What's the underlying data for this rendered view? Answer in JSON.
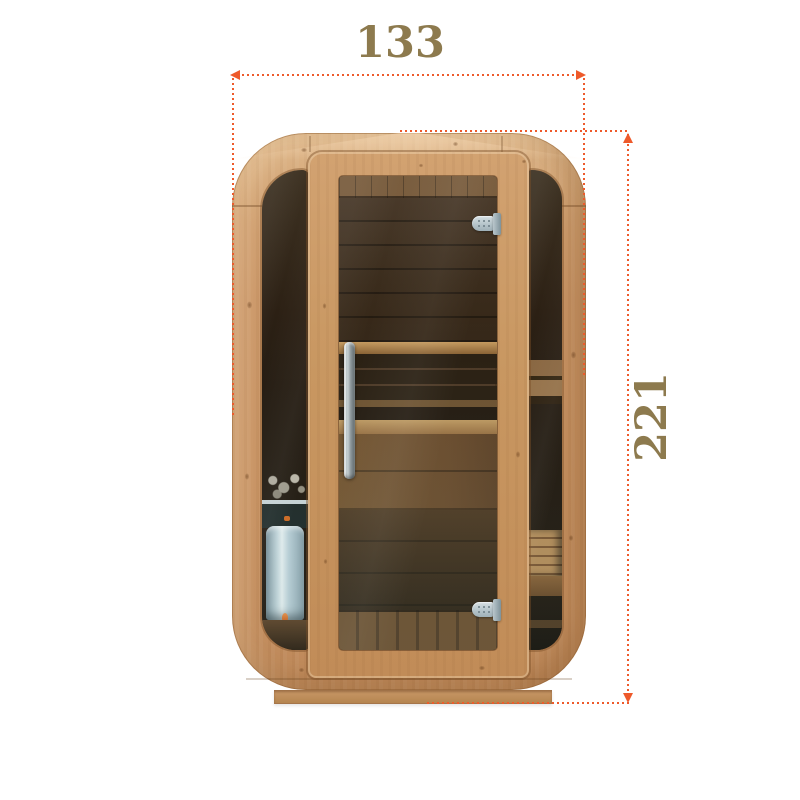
{
  "annotations": {
    "width_label": "133",
    "height_label": "221"
  },
  "colors": {
    "background": "#ffffff",
    "dimension_line": "#ee5a2b",
    "dimension_label": "#8d7a4e",
    "wood_light": "#d6aa7a",
    "wood_mid": "#c79262",
    "wood_shadow": "#a1713f",
    "interior_dark": "#2b2013",
    "heater_metal": "#bed3dc",
    "hinge_metal": "#b6c5cb",
    "plinth_wood": "#c99868"
  }
}
